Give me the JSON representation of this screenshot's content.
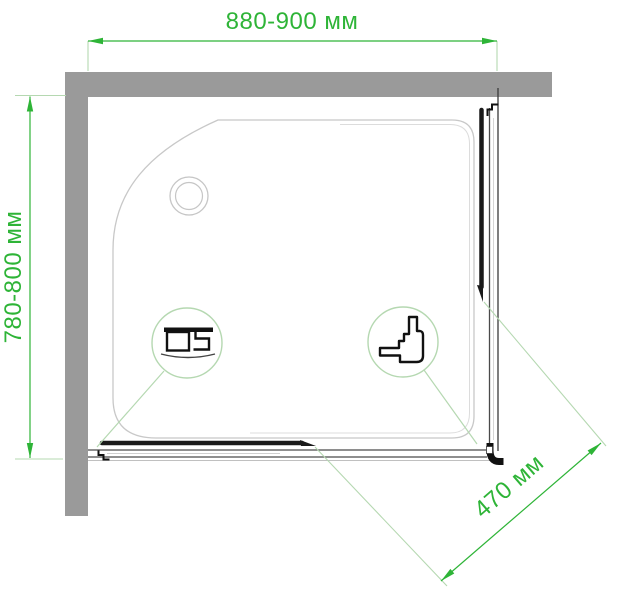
{
  "diagram": {
    "type": "shower-enclosure-top-view",
    "dimensions": {
      "width_label": "880-900 мм",
      "depth_label": "780-800 мм",
      "door_opening_label": "470 мм"
    },
    "callouts": [
      {
        "id": "left-detail",
        "icon": "bottom-rail-profile-icon"
      },
      {
        "id": "right-detail",
        "icon": "corner-roller-profile-icon"
      }
    ],
    "colors": {
      "dimension_green": "#2eb437",
      "pale_green": "#b5d8b1",
      "wall_gray": "#9a9a9a",
      "tray_outline_gray": "#c8c8c8",
      "profile_black": "#1a1a1a"
    }
  }
}
